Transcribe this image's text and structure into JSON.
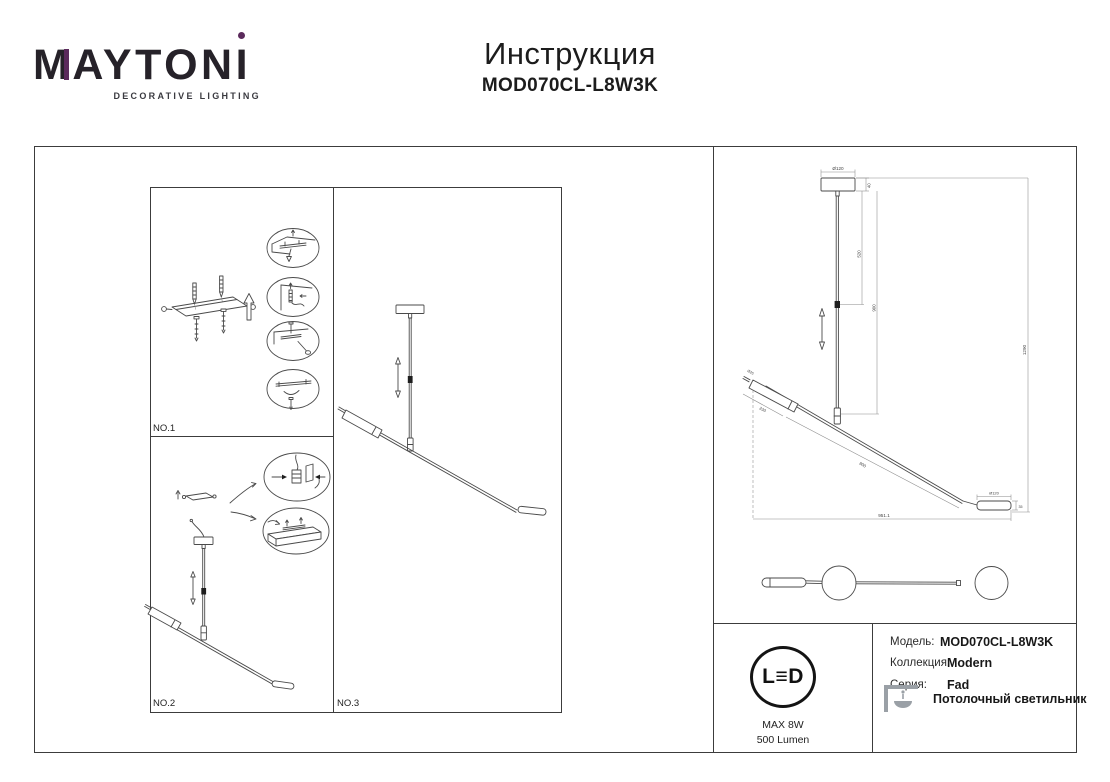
{
  "header": {
    "logo_m": "M",
    "logo_mid": "AYTON",
    "logo_i": "I",
    "tagline": "DECORATIVE LIGHTING",
    "title": "Инструкция",
    "model": "MOD070CL-L8W3K",
    "accent_color": "#5b2a5c"
  },
  "panels": {
    "no1": "NO.1",
    "no2": "NO.2",
    "no3": "NO.3"
  },
  "dims": {
    "canopy_d": "Ø120",
    "canopy_h": "40",
    "rod_upper": "520",
    "rod_total": "900",
    "height_total": "1290",
    "bar_len": "800",
    "shade_len": "230",
    "tip_d": "Ø25",
    "end_d": "Ø120",
    "end_h": "35",
    "width_total": "951.1"
  },
  "info": {
    "led_l": "L",
    "led_e": "≡",
    "led_d": "D",
    "max_power": "MAX 8W",
    "lumens": "500 Lumen",
    "rows": [
      {
        "label": "Модель:",
        "value": "MOD070CL-L8W3K"
      },
      {
        "label": "Коллекция:",
        "value": "Modern"
      },
      {
        "label": "Серия:",
        "value": "Fad"
      }
    ],
    "type": "Потолочный светильник"
  }
}
